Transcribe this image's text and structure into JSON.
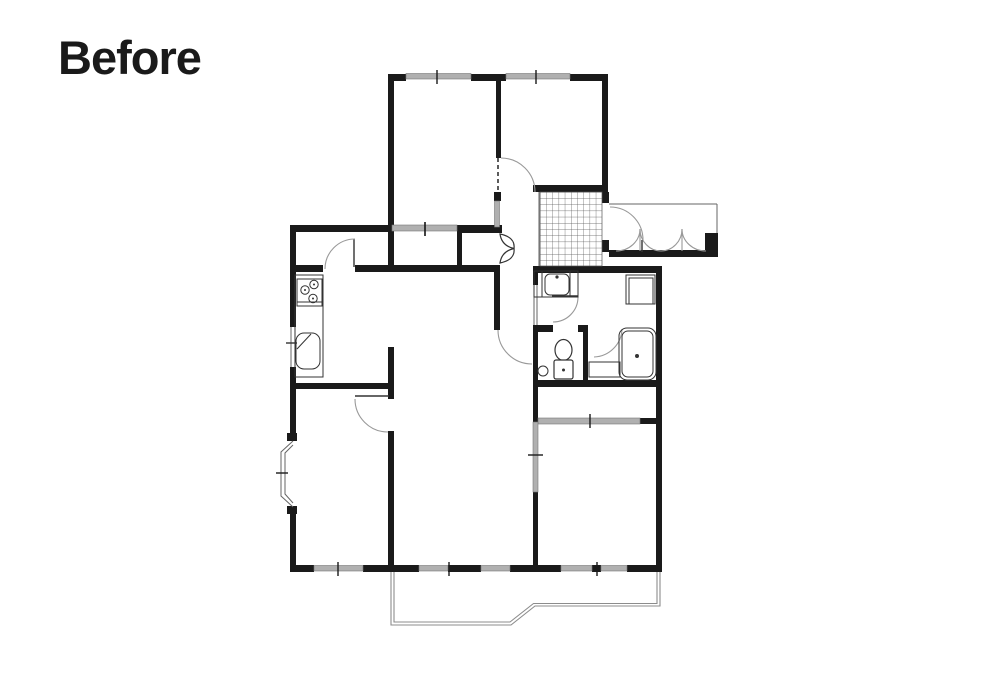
{
  "title": "Before",
  "plan": {
    "type": "apartment-floor-plan",
    "state_label": "Before",
    "colors": {
      "background": "#ffffff",
      "title_color": "#1a1a1a",
      "wall": "#1a1a1a",
      "window": "#b0b0b0",
      "window_edge": "#777777",
      "door_arc": "#999999",
      "fixture": "#333333",
      "grid": "#555555",
      "balcony": "#8c8c8c"
    },
    "symbols": [
      "entry-double-folding-door",
      "genkan-tile-grid",
      "hall-closet-bifold-door",
      "sliding-closet-door",
      "hinged-door-arc",
      "dashed-door-opening",
      "bay-window",
      "balcony-outline",
      "kitchen-stove",
      "kitchen-sink",
      "washbasin",
      "washing-machine-pan",
      "toilet",
      "hand-basin",
      "bathtub",
      "window-bar",
      "wall-tick"
    ]
  }
}
